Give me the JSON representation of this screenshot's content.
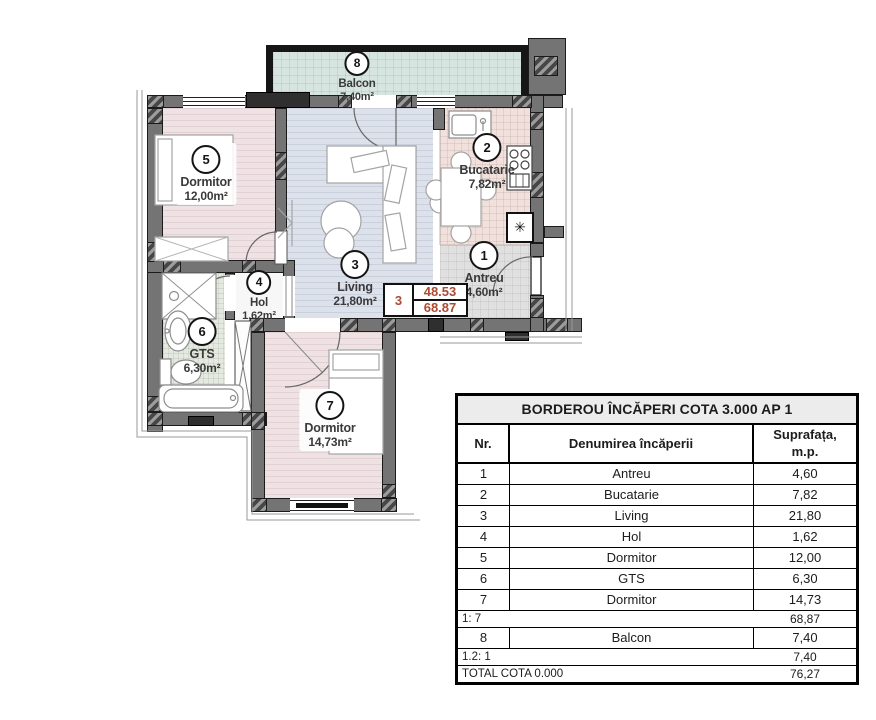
{
  "plan": {
    "labels": [
      {
        "num": "8",
        "name": "Balcon",
        "area": "7,40m²"
      },
      {
        "num": "5",
        "name": "Dormitor",
        "area": "12,00m²"
      },
      {
        "num": "3",
        "name": "Living",
        "area": "21,80m²"
      },
      {
        "num": "2",
        "name": "Bucatarie",
        "area": "7,82m²"
      },
      {
        "num": "1",
        "name": "Antreu",
        "area": "4,60m²"
      },
      {
        "num": "4",
        "name": "Hol",
        "area": "1,62m²"
      },
      {
        "num": "6",
        "name": "GTS",
        "area": "6,30m²"
      },
      {
        "num": "7",
        "name": "Dormitor",
        "area": "14,73m²"
      }
    ],
    "score_box": {
      "unit": "3",
      "value_top": "48.53",
      "value_bottom": "68.87"
    },
    "closet_symbol": "✳"
  },
  "table": {
    "title": "BORDEROU ÎNCĂPERI COTA 3.000 AP 1",
    "col_nr": "Nr.",
    "col_name": "Denumirea încăperii",
    "col_area_line1": "Suprafața,",
    "col_area_line2": "m.p.",
    "rows": [
      {
        "nr": "1",
        "name": "Antreu",
        "area": "4,60"
      },
      {
        "nr": "2",
        "name": "Bucatarie",
        "area": "7,82"
      },
      {
        "nr": "3",
        "name": "Living",
        "area": "21,80"
      },
      {
        "nr": "4",
        "name": "Hol",
        "area": "1,62"
      },
      {
        "nr": "5",
        "name": "Dormitor",
        "area": "12,00"
      },
      {
        "nr": "6",
        "name": "GTS",
        "area": "6,30"
      },
      {
        "nr": "7",
        "name": "Dormitor",
        "area": "14,73"
      }
    ],
    "subtotal": {
      "label": "1: 7",
      "value": "68,87"
    },
    "balcony_row": {
      "nr": "8",
      "name": "Balcon",
      "area": "7,40"
    },
    "subtotal2": {
      "label": "1.2: 1",
      "value": "7,40"
    },
    "total": {
      "label": "TOTAL COTA 0.000",
      "value": "76,27"
    }
  },
  "colors": {
    "wall": "#747474",
    "wall_dark": "#2f2f2f",
    "score_red": "#ad4a32",
    "floor_bedroom": "#eee2e4",
    "floor_living": "#dde1ea",
    "floor_kitchen": "#f2e0dc",
    "floor_hall": "#e0e0e0",
    "floor_bath": "#e4eae0",
    "floor_balcony": "#d7e5e1"
  }
}
